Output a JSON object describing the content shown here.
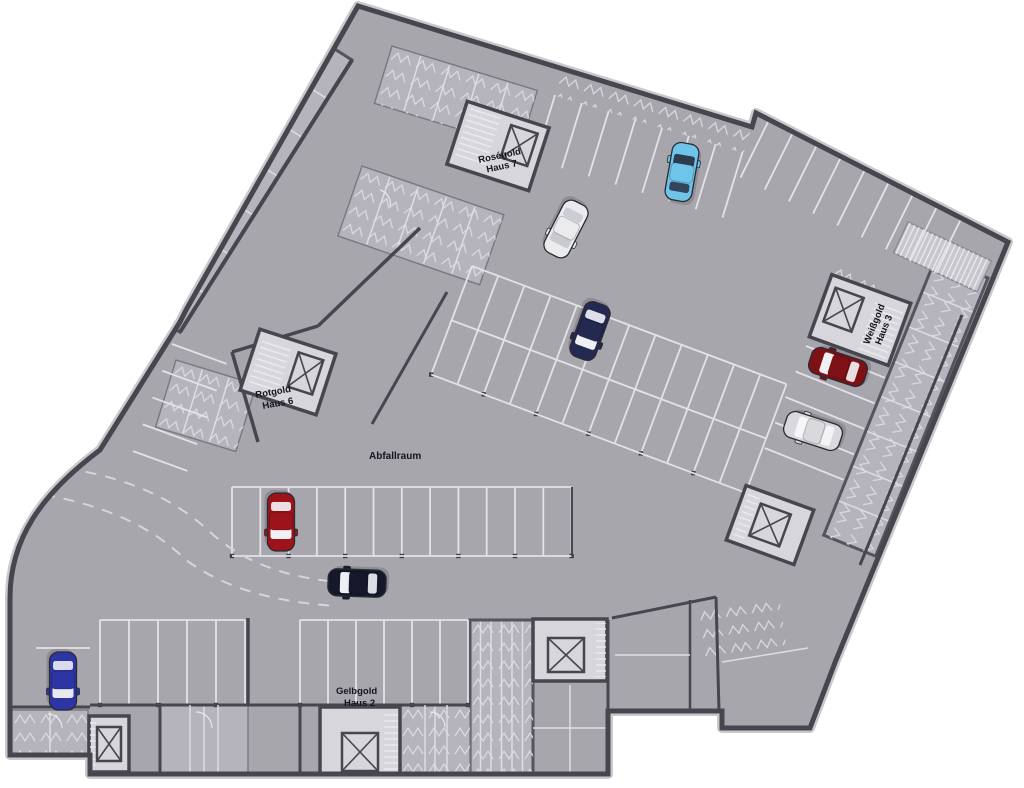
{
  "page": {
    "background": "#ffffff"
  },
  "plan": {
    "type": "underground-parking-floor-plan",
    "labels": {
      "rosegold_line1": "Roségold",
      "rosegold_line2": "Haus 7",
      "weissgold_line1": "Weißgold",
      "weissgold_line2": "Haus 3",
      "rotgold_line1": "Rotgold",
      "rotgold_line2": "Haus 6",
      "gelbgold_line1": "Gelbgold",
      "gelbgold_line2": "Haus 2",
      "abfallraum": "Abfallraum"
    },
    "colors": {
      "floor": "#a8a6ad",
      "wall": "#46464e",
      "wall_halo": "#c9c9cd",
      "room": "#d7d6db",
      "storage": "#b5b3bb",
      "storage_line": "#dedde3",
      "stall_line": "#e3e2e7",
      "ramp": "#c8c7cd",
      "label": "#15151d",
      "column": "#3c3c44"
    },
    "cars": [
      {
        "name": "light-blue-car",
        "color": "#6fc4e9",
        "window": "#2e3a4d",
        "x": 682,
        "y": 172,
        "rot": 10
      },
      {
        "name": "white-car",
        "color": "#ebebed",
        "window": "#c7cad1",
        "x": 566,
        "y": 229,
        "rot": 207
      },
      {
        "name": "navy-car",
        "color": "#232950",
        "window": "#eef0f5",
        "x": 590,
        "y": 331,
        "rot": 200
      },
      {
        "name": "dark-red-car",
        "color": "#7d1115",
        "window": "#f1f1f4",
        "x": 838,
        "y": 367,
        "rot": 288
      },
      {
        "name": "silver-car",
        "color": "#d9d9dd",
        "window": "#f6f6f8",
        "x": 813,
        "y": 431,
        "rot": 288
      },
      {
        "name": "red-car",
        "color": "#9c131b",
        "window": "#f1f1f4",
        "x": 281,
        "y": 522,
        "rot": 180
      },
      {
        "name": "black-car",
        "color": "#15182b",
        "window": "#eef0f5",
        "x": 357,
        "y": 583,
        "rot": 272
      },
      {
        "name": "blue-car",
        "color": "#2d35a5",
        "window": "#e8e9f1",
        "x": 63,
        "y": 681,
        "rot": 180
      }
    ]
  }
}
